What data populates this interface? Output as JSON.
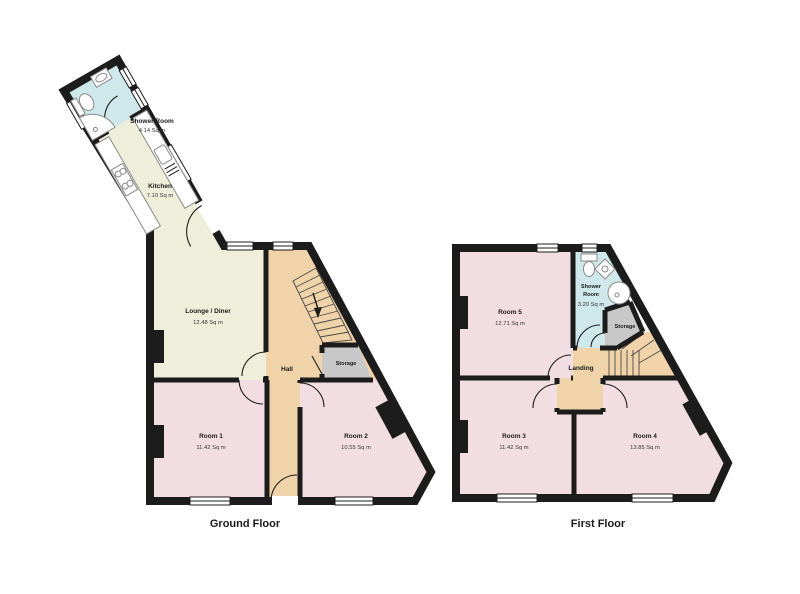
{
  "colors": {
    "wall": "#1c1c1c",
    "bedroom_pink": "#f2dee2",
    "living_cream": "#efeeda",
    "hall_tan": "#f0d3a9",
    "bath_blue": "#cfe8ec",
    "storage_grey": "#c8c8c8"
  },
  "floors": [
    {
      "label": "Ground Floor",
      "rooms": [
        {
          "name": "Shower Room",
          "area": "4.14 Sq m"
        },
        {
          "name": "Kitchen",
          "area": "7.10 Sq m"
        },
        {
          "name": "Lounge / Diner",
          "area": "12.48 Sq m"
        },
        {
          "name": "Hall"
        },
        {
          "name": "Storage"
        },
        {
          "name": "Room 1",
          "area": "11.42 Sq m"
        },
        {
          "name": "Room 2",
          "area": "10.55 Sq m"
        }
      ]
    },
    {
      "label": "First Floor",
      "rooms": [
        {
          "name": "Room 5",
          "area": "12.71 Sq m"
        },
        {
          "name": "Shower",
          "name2": "Room",
          "area": "3.20 Sq m"
        },
        {
          "name": "Storage"
        },
        {
          "name": "Landing"
        },
        {
          "name": "Room 3",
          "area": "11.42 Sq m"
        },
        {
          "name": "Room 4",
          "area": "13.85 Sq m"
        }
      ]
    }
  ]
}
